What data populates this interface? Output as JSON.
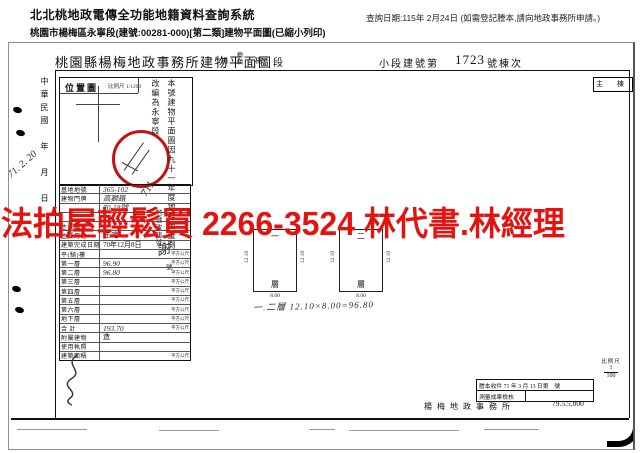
{
  "header": {
    "system_title": "北北桃地政電傳全功能地籍資料查詢系統",
    "query_date": "查詢日期:115年 2月24日 (如需登記謄本,請向地政事務所申請。)",
    "subtitle": "桃園市楊梅區永寧段(建號:00281-000)[第二類]建物平面圖(已縮小列印)"
  },
  "watermark": {
    "text": "法拍屋輕鬆買  2266-3524  林代書.林經理",
    "color": "#e31310"
  },
  "doc": {
    "title": "桃園縣楊梅地政事務所建物平面圖",
    "admin_chars": [
      "楊",
      "梅鎮",
      "楊",
      "段"
    ],
    "lot_label": "小段建號第",
    "lot_number": "1723",
    "lot_suffix": "號棟次",
    "corner_box": "主 棟",
    "margin_label": "中華民國　年　月　日",
    "margin_hand_date": "71. 2. 20",
    "location_map": {
      "label": "位置圖",
      "scale": "比例尺 1/1200"
    },
    "annotations": {
      "remeasure": "本號建物平面圖因九十一年度地籍圖重測",
      "renamed": "改編為永寧段",
      "lot_hand": "711",
      "lot_note": "地號改建號",
      "sign": "謝",
      "suffix": "號"
    },
    "left_table": {
      "rows": [
        {
          "label": "基地地號",
          "value": "365-102",
          "unit": "",
          "hand": true
        },
        {
          "label": "建物門牌",
          "value": "高獅路",
          "unit": "",
          "hand": true
        },
        {
          "label": "",
          "value": "70-18號",
          "unit": "",
          "hand": true
        },
        {
          "label": "",
          "value": "",
          "unit": "",
          "hand": false
        },
        {
          "label": "主要構造",
          "value": "",
          "unit": "",
          "hand": false
        },
        {
          "label": "主要用途",
          "value": "住 宅",
          "unit": "",
          "hand": false
        },
        {
          "label": "建築完成日期",
          "value": "70年12月8日",
          "unit": "",
          "hand": false
        },
        {
          "label": "平(騎)樓",
          "value": "",
          "unit": "平方公尺",
          "hand": false
        },
        {
          "label": "第一層",
          "value": "96.90",
          "unit": "平方公尺",
          "hand": true
        },
        {
          "label": "第二層",
          "value": "96.80",
          "unit": "平方公尺",
          "hand": true
        },
        {
          "label": "第三層",
          "value": "",
          "unit": "平方公尺",
          "hand": false
        },
        {
          "label": "第四層",
          "value": "",
          "unit": "平方公尺",
          "hand": false
        },
        {
          "label": "第五層",
          "value": "",
          "unit": "平方公尺",
          "hand": false
        },
        {
          "label": "第六層",
          "value": "",
          "unit": "平方公尺",
          "hand": false
        },
        {
          "label": "地下層",
          "value": "",
          "unit": "平方公尺",
          "hand": false
        },
        {
          "label": "合 計",
          "value": "193.70",
          "unit": "平方公尺",
          "hand": true
        },
        {
          "label": "附屬建物",
          "value": "造",
          "unit": "",
          "hand": false
        },
        {
          "label": "使用執照",
          "value": "",
          "unit": "",
          "hand": false
        },
        {
          "label": "建築面積",
          "value": "",
          "unit": "平方公尺",
          "hand": false
        }
      ]
    },
    "floor_plans": [
      {
        "top_label": "一",
        "bottom_label": "層",
        "dim_left": "12.10",
        "dim_right": "12.10",
        "dim_bottom": "8.00"
      },
      {
        "top_label": "二",
        "bottom_label": "層",
        "dim_left": "12.10",
        "dim_right": "12.10",
        "dim_bottom": "8.00"
      }
    ],
    "area_formula": "一.二層 12.10×8.00=96.80",
    "scale_note": {
      "label": "比例尺",
      "num": "1",
      "den": "100"
    },
    "receipt": {
      "line1": "謄本收件 71 年 3 月 13 日第　號",
      "line2": "測量成果檢核"
    },
    "office_name": "楊梅地政事務所",
    "print_code": "79.5.5,000"
  }
}
